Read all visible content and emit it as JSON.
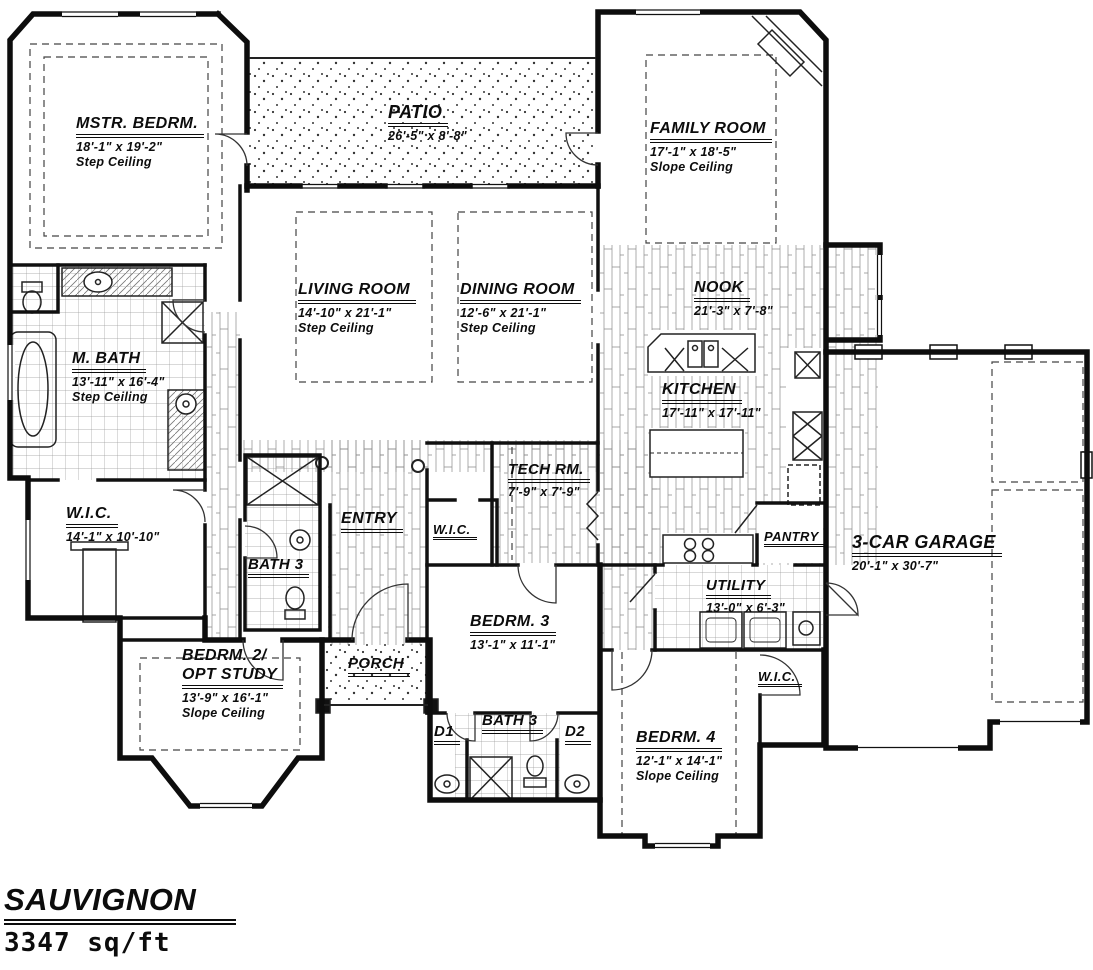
{
  "plan": {
    "name": "SAUVIGNON",
    "area": "3347 sq/ft"
  },
  "rooms": {
    "mstr_bedrm": {
      "name": "MSTR. BEDRM.",
      "dims": "18'-1\" x 19'-2\"",
      "note": "Step Ceiling"
    },
    "patio": {
      "name": "PATIO",
      "dims": "26'-5\" x 8'-8\""
    },
    "family_room": {
      "name": "FAMILY ROOM",
      "dims": "17'-1\" x 18'-5\"",
      "note": "Slope Ceiling"
    },
    "living_room": {
      "name": "LIVING ROOM",
      "dims": "14'-10\" x 21'-1\"",
      "note": "Step Ceiling"
    },
    "dining_room": {
      "name": "DINING ROOM",
      "dims": "12'-6\" x 21'-1\"",
      "note": "Step Ceiling"
    },
    "nook": {
      "name": "NOOK",
      "dims": "21'-3\" x 7'-8\""
    },
    "m_bath": {
      "name": "M. BATH",
      "dims": "13'-11\" x 16'-4\"",
      "note": "Step Ceiling"
    },
    "kitchen": {
      "name": "KITCHEN",
      "dims": "17'-11\" x 17'-11\""
    },
    "wic_master": {
      "name": "W.I.C.",
      "dims": "14'-1\" x 10'-10\""
    },
    "tech_rm": {
      "name": "TECH RM.",
      "dims": "7'-9\" x 7'-9\""
    },
    "entry": {
      "name": "ENTRY"
    },
    "wic_hall": {
      "name": "W.I.C."
    },
    "bath3_hall": {
      "name": "BATH 3"
    },
    "pantry": {
      "name": "PANTRY"
    },
    "garage": {
      "name": "3-CAR GARAGE",
      "dims": "20'-1\" x 30'-7\""
    },
    "utility": {
      "name": "UTILITY",
      "dims": "13'-0\" x 6'-3\""
    },
    "bedrm3": {
      "name": "BEDRM. 3",
      "dims": "13'-1\" x 11'-1\""
    },
    "bedrm2": {
      "name": "BEDRM. 2/",
      "name2": "OPT STUDY",
      "dims": "13'-9\" x 16'-1\"",
      "note": "Slope Ceiling"
    },
    "porch": {
      "name": "PORCH"
    },
    "d1": {
      "name": "D1"
    },
    "bath3_jj": {
      "name": "BATH 3"
    },
    "d2": {
      "name": "D2"
    },
    "bedrm4": {
      "name": "BEDRM. 4",
      "dims": "12'-1\" x 14'-1\"",
      "note": "Slope Ceiling"
    },
    "wic_bed4": {
      "name": "W.I.C."
    }
  }
}
